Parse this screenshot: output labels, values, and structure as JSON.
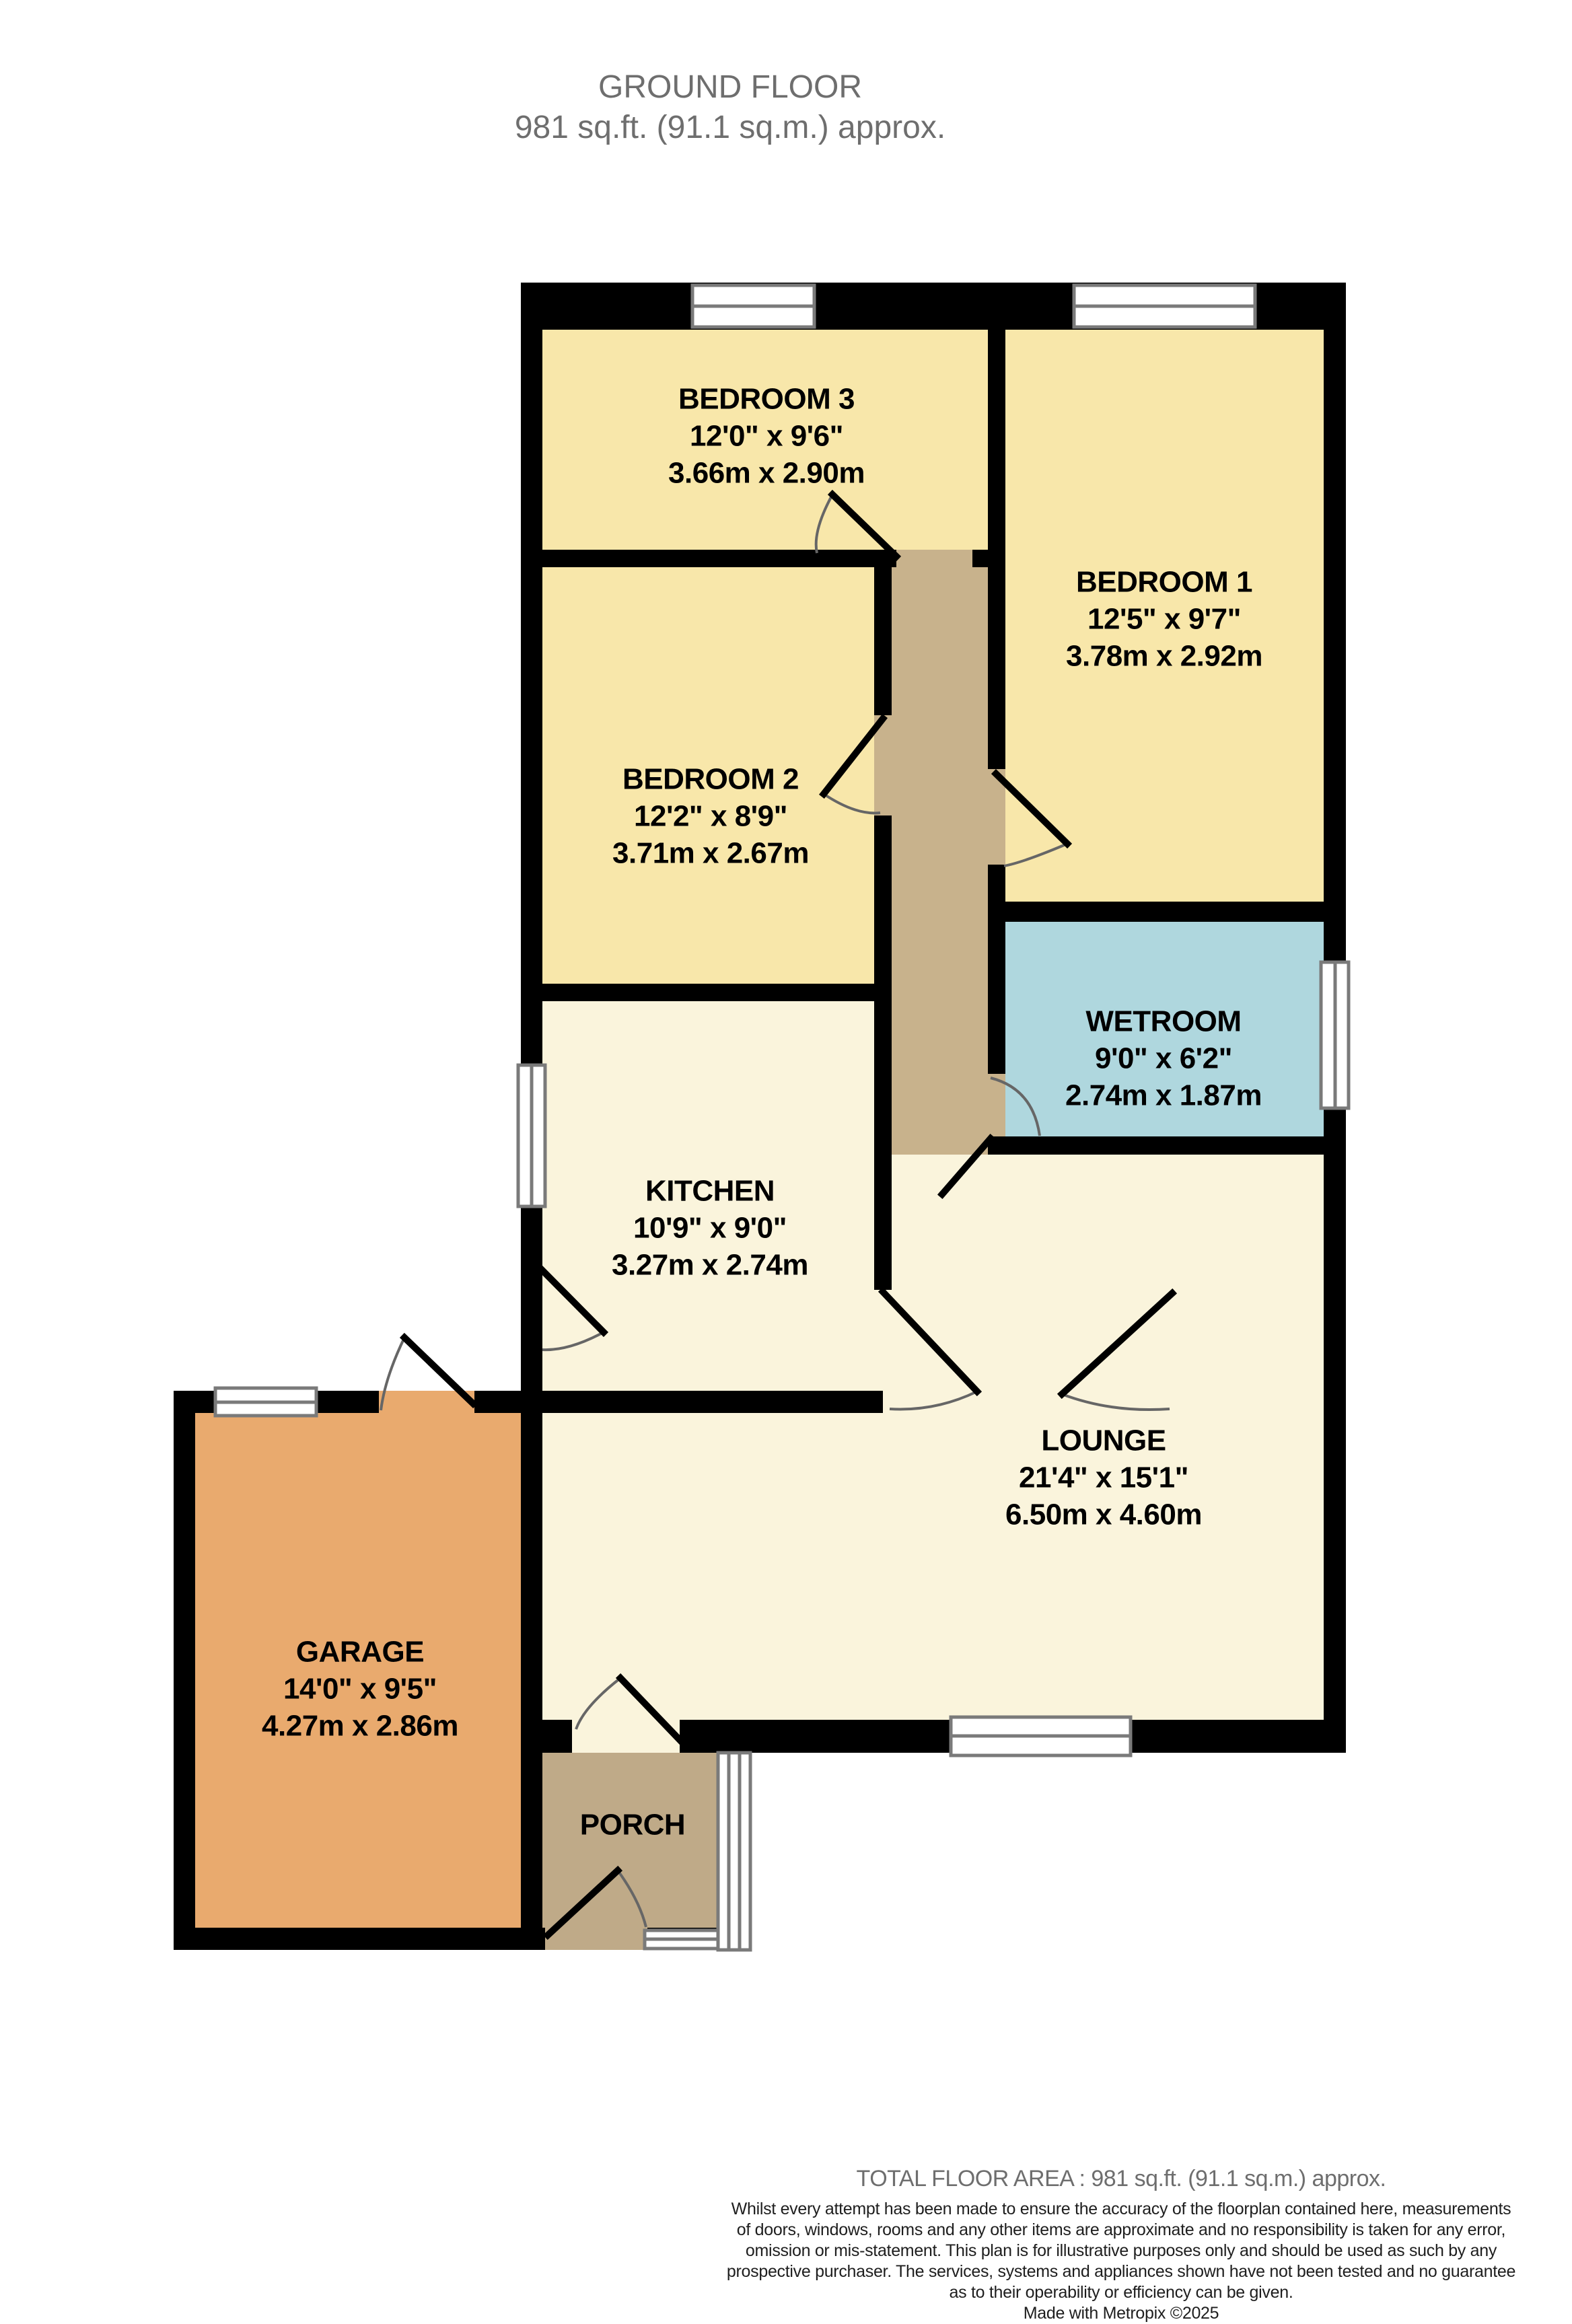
{
  "title": {
    "line1": "GROUND FLOOR",
    "line2": "981 sq.ft. (91.1 sq.m.) approx."
  },
  "rooms": {
    "bedroom3": {
      "name": "BEDROOM 3",
      "imperial": "12'0\"  x 9'6\"",
      "metric": "3.66m  x 2.90m"
    },
    "bedroom1": {
      "name": "BEDROOM 1",
      "imperial": "12'5\"  x 9'7\"",
      "metric": "3.78m  x 2.92m"
    },
    "bedroom2": {
      "name": "BEDROOM 2",
      "imperial": "12'2\"  x 8'9\"",
      "metric": "3.71m  x 2.67m"
    },
    "wetroom": {
      "name": "WETROOM",
      "imperial": "9'0\"  x 6'2\"",
      "metric": "2.74m  x 1.87m"
    },
    "kitchen": {
      "name": "KITCHEN",
      "imperial": "10'9\"  x 9'0\"",
      "metric": "3.27m  x 2.74m"
    },
    "lounge": {
      "name": "LOUNGE",
      "imperial": "21'4\"  x 15'1\"",
      "metric": "6.50m  x 4.60m"
    },
    "garage": {
      "name": "GARAGE",
      "imperial": "14'0\"  x 9'5\"",
      "metric": "4.27m  x 2.86m"
    },
    "porch": {
      "name": "PORCH"
    }
  },
  "footer": {
    "total": "TOTAL FLOOR AREA : 981 sq.ft. (91.1 sq.m.) approx.",
    "disclaimer": [
      "Whilst every attempt has been made to ensure the accuracy of the floorplan contained here, measurements",
      "of doors, windows, rooms and any other items are approximate and no responsibility is taken for any error,",
      "omission or mis-statement. This plan is for illustrative purposes only and should be used as such by any",
      "prospective purchaser. The services, systems and appliances shown have not been tested and no guarantee",
      "as to their operability or efficiency can be given."
    ],
    "credit": "Made with Metropix ©2025"
  },
  "colors": {
    "bedroom": "#F8E7AA",
    "living": "#FAF4DC",
    "wetroom": "#AFD7DE",
    "hall": "#C8B28C",
    "porch": "#BFAA88",
    "garage": "#E9AA6E",
    "wall": "#000000",
    "window_frame": "#7A7A7A",
    "door_arc": "#666666",
    "title_text": "#6E6E6E",
    "disclaimer_text": "#1E1E1E"
  }
}
